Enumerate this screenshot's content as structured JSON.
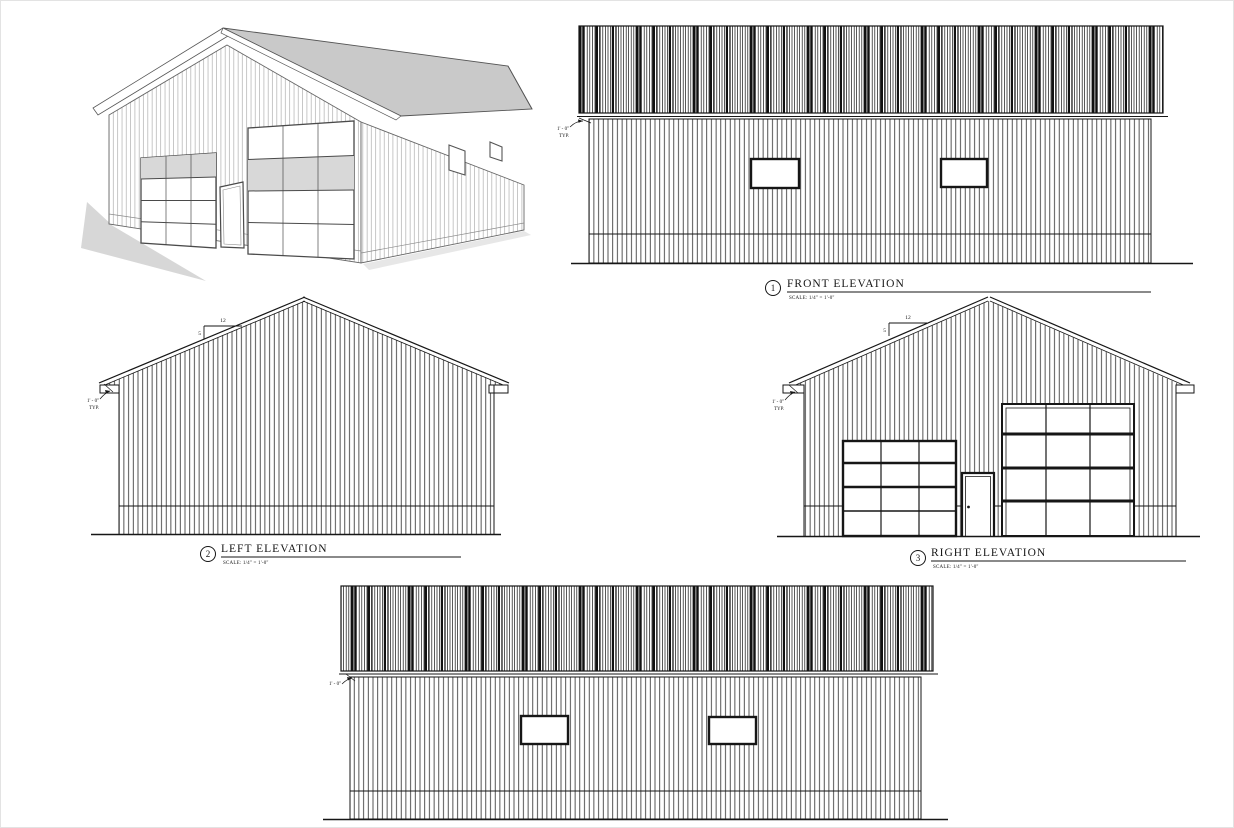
{
  "sheet": {
    "ink": "#161616",
    "roof_fill": "#c9c9c9",
    "shadow_fill": "#d7d7d7"
  },
  "views": {
    "perspective": {
      "name": "3D perspective rendering of garage"
    },
    "front": {
      "number": "1",
      "title": "FRONT ELEVATION",
      "scale": "SCALE:  1/4\" = 1'-0\"",
      "overhang_note_line1": "1' - 0\"",
      "overhang_note_line2": "TYP."
    },
    "left": {
      "number": "2",
      "title": "LEFT ELEVATION",
      "scale": "SCALE:  1/4\" = 1'-0\"",
      "overhang_note_line1": "1' - 0\"",
      "overhang_note_line2": "TYP.",
      "pitch_run": "12",
      "pitch_rise": "5"
    },
    "right": {
      "number": "3",
      "title": "RIGHT ELEVATION",
      "scale": "SCALE:  1/4\" = 1'-0\"",
      "overhang_note_line1": "1' - 0\"",
      "overhang_note_line2": "TYP.",
      "pitch_run": "12",
      "pitch_rise": "5"
    },
    "rear": {
      "overhang_note_line1": "1' - 0\""
    }
  }
}
